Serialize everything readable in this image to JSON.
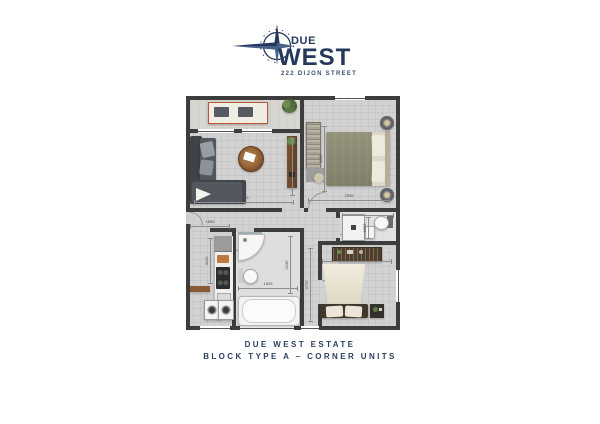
{
  "logo": {
    "name_top": "DUE",
    "name_bottom": "WEST",
    "address": "222 DIJON STREET",
    "icon": "compass-rose-icon"
  },
  "caption": {
    "line1": "DUE WEST ESTATE",
    "line2": "BLOCK TYPE A – CORNER UNITS"
  },
  "colors": {
    "brand_navy": "#24395c",
    "wall": "#3d3d3d",
    "floor": "#d2d2d2",
    "accent_terracotta": "#b85a3a",
    "duvet_olive": "#8d8d76",
    "duvet_cream": "#ece7d7",
    "wood": "#6f4b2c"
  },
  "dims": {
    "living_width": "2999",
    "living_depth": "3080",
    "bedroom1_width": "2995",
    "bedroom1_depth": "3115",
    "wc_width": "2199",
    "wc_depth": "1005",
    "kitchen_width": "1850",
    "kitchen_depth": "3110",
    "bath_width": "1825",
    "bath_depth": "2135",
    "bedroom2_width": "2105",
    "bedroom2_depth": "2725"
  }
}
